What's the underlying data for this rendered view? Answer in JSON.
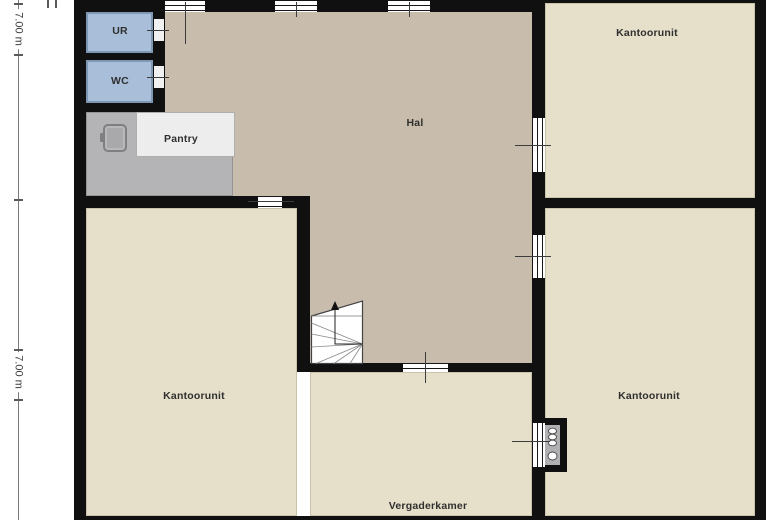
{
  "floor_plan": {
    "rooms": {
      "hal": {
        "label": "Hal"
      },
      "kantoorunit_top_right": {
        "label": "Kantoorunit"
      },
      "kantoorunit_bottom_left": {
        "label": "Kantoorunit"
      },
      "kantoorunit_bottom_right": {
        "label": "Kantoorunit"
      },
      "vergaderkamer": {
        "label": "Vergaderkamer"
      },
      "pantry": {
        "label": "Pantry"
      },
      "urinal": {
        "label": "UR"
      },
      "toilet": {
        "label": "WC"
      }
    },
    "dimensions": {
      "left_top": {
        "label": "7.00 m"
      },
      "left_bottom": {
        "label": "7.00 m"
      }
    },
    "colors": {
      "wall": "#101010",
      "hal_floor": "#c8bdad",
      "office_floor": "#e6dfc9",
      "sanitary_floor": "#a9bed8",
      "pantry_floor": "#b4b4b6",
      "counter": "#ededed",
      "background": "#ffffff"
    }
  }
}
